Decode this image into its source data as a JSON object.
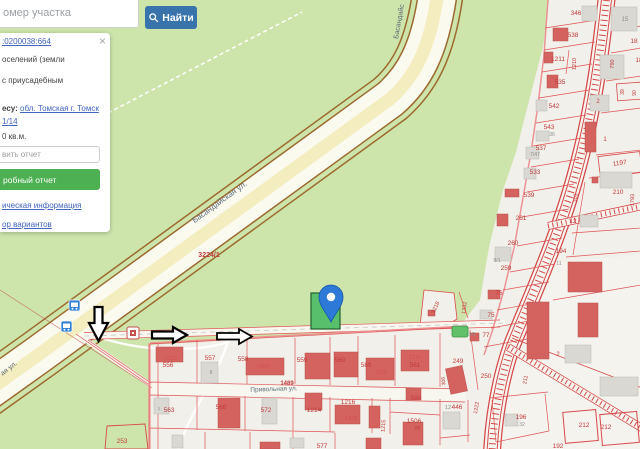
{
  "search": {
    "placeholder": "омер участка",
    "button_label": "Найти"
  },
  "panel": {
    "close": "×",
    "cadastral_link": ":0200038:664",
    "line1": "оселений (земли",
    "line2": "с приусадебным",
    "address_label": "есу:",
    "address_link": "обл. Томская г. Томск",
    "address_link2": "1/14",
    "area": "0 кв.м.",
    "report_placeholder": "вить отчет",
    "report_button": "робный отчет",
    "link_info": "ическая информация",
    "link_variants": "ор вариантов"
  },
  "map": {
    "selected_marker_parcel": "66",
    "labels": [
      {
        "t": "Басандайская ул.",
        "x": 221,
        "y": 204,
        "r": -36,
        "c": "st",
        "s": 8
      },
      {
        "t": "Басандайс",
        "x": 401,
        "y": 22,
        "r": -80,
        "c": "st",
        "s": 7
      },
      {
        "t": "ая ул.",
        "x": 10,
        "y": 370,
        "r": -38,
        "c": "st",
        "s": 7
      },
      {
        "t": "Привольная ул.",
        "x": 274,
        "y": 391,
        "r": -2,
        "c": "st",
        "s": 6.5
      },
      {
        "t": "3224/1",
        "x": 209,
        "y": 257,
        "c": "rn",
        "s": 7
      },
      {
        "t": "1489",
        "x": 287,
        "y": 385,
        "c": "rn",
        "s": 6
      },
      {
        "t": "556",
        "x": 168,
        "y": 367,
        "c": "p"
      },
      {
        "t": "1325",
        "x": 171,
        "y": 360,
        "c": "b",
        "s": 5.5
      },
      {
        "t": "557",
        "x": 210,
        "y": 360,
        "c": "p"
      },
      {
        "t": "8",
        "x": 211,
        "y": 374,
        "c": "g",
        "s": 5
      },
      {
        "t": "558",
        "x": 243,
        "y": 361,
        "c": "p"
      },
      {
        "t": "6404",
        "x": 263,
        "y": 368,
        "c": "b",
        "s": 5.5
      },
      {
        "t": "559",
        "x": 302,
        "y": 362,
        "c": "p"
      },
      {
        "t": "560",
        "x": 340,
        "y": 362,
        "c": "p"
      },
      {
        "t": "589",
        "x": 366,
        "y": 367,
        "c": "p"
      },
      {
        "t": "1220",
        "x": 381,
        "y": 374,
        "c": "b",
        "s": 5.5
      },
      {
        "t": "1719",
        "x": 415,
        "y": 359,
        "c": "b",
        "s": 5.5
      },
      {
        "t": "561",
        "x": 415,
        "y": 367,
        "c": "p"
      },
      {
        "t": "249",
        "x": 458,
        "y": 363,
        "c": "p"
      },
      {
        "t": "306",
        "x": 445,
        "y": 381,
        "r": -95,
        "c": "p",
        "s": 5
      },
      {
        "t": "250",
        "x": 486,
        "y": 378,
        "c": "p"
      },
      {
        "t": "563",
        "x": 169,
        "y": 412,
        "c": "p"
      },
      {
        "t": "1",
        "x": 159,
        "y": 410,
        "c": "g",
        "s": 4.5
      },
      {
        "t": "568",
        "x": 221,
        "y": 409,
        "c": "p"
      },
      {
        "t": "572",
        "x": 266,
        "y": 412,
        "c": "p"
      },
      {
        "t": "1214",
        "x": 314,
        "y": 412,
        "c": "p"
      },
      {
        "t": "1216",
        "x": 348,
        "y": 404,
        "c": "p"
      },
      {
        "t": "1428",
        "x": 351,
        "y": 420,
        "c": "b",
        "s": 5.5
      },
      {
        "t": "1215",
        "x": 385,
        "y": 426,
        "r": -85,
        "c": "p",
        "s": 5.5
      },
      {
        "t": "584",
        "x": 416,
        "y": 400,
        "c": "p"
      },
      {
        "t": "1506",
        "x": 414,
        "y": 423,
        "c": "p"
      },
      {
        "t": "78",
        "x": 417,
        "y": 430,
        "c": "p",
        "s": 5
      },
      {
        "t": "12",
        "x": 448,
        "y": 409,
        "c": "g",
        "s": 5.5
      },
      {
        "t": "446",
        "x": 457,
        "y": 409,
        "c": "p"
      },
      {
        "t": "1222",
        "x": 478,
        "y": 408,
        "r": -80,
        "c": "p",
        "s": 5.5
      },
      {
        "t": "211",
        "x": 527,
        "y": 380,
        "r": -80,
        "c": "p",
        "s": 5.5
      },
      {
        "t": "196",
        "x": 521,
        "y": 419,
        "c": "p"
      },
      {
        "t": "32",
        "x": 522,
        "y": 426,
        "c": "g",
        "s": 5
      },
      {
        "t": "212",
        "x": 584,
        "y": 427,
        "c": "p"
      },
      {
        "t": "212",
        "x": 606,
        "y": 429,
        "c": "p"
      },
      {
        "t": "192",
        "x": 558,
        "y": 448,
        "c": "p"
      },
      {
        "t": "2",
        "x": 558,
        "y": 356,
        "c": "p",
        "s": 6
      },
      {
        "t": "577",
        "x": 322,
        "y": 448,
        "c": "p"
      },
      {
        "t": "253",
        "x": 122,
        "y": 443,
        "c": "p"
      },
      {
        "t": "346",
        "x": 576,
        "y": 15,
        "c": "p"
      },
      {
        "t": "538",
        "x": 573,
        "y": 37,
        "c": "p"
      },
      {
        "t": "1211",
        "x": 558,
        "y": 61,
        "c": "p"
      },
      {
        "t": "1210",
        "x": 576,
        "y": 64,
        "r": -90,
        "c": "p",
        "s": 5.5
      },
      {
        "t": "535",
        "x": 560,
        "y": 84,
        "c": "p"
      },
      {
        "t": "542",
        "x": 554,
        "y": 108,
        "c": "p"
      },
      {
        "t": "543",
        "x": 549,
        "y": 129,
        "c": "p"
      },
      {
        "t": "36",
        "x": 552,
        "y": 136,
        "c": "g",
        "s": 5
      },
      {
        "t": "537",
        "x": 541,
        "y": 150,
        "c": "p"
      },
      {
        "t": "7/47",
        "x": 535,
        "y": 156,
        "c": "g",
        "s": 5
      },
      {
        "t": "533",
        "x": 535,
        "y": 174,
        "c": "p"
      },
      {
        "t": "539",
        "x": 529,
        "y": 197,
        "c": "p"
      },
      {
        "t": "261",
        "x": 521,
        "y": 220,
        "c": "p"
      },
      {
        "t": "260",
        "x": 513,
        "y": 245,
        "c": "p"
      },
      {
        "t": "259",
        "x": 506,
        "y": 270,
        "c": "p"
      },
      {
        "t": "9/1",
        "x": 497,
        "y": 262,
        "c": "g",
        "s": 5
      },
      {
        "t": "76",
        "x": 499,
        "y": 295,
        "c": "p"
      },
      {
        "t": "75",
        "x": 491,
        "y": 317,
        "c": "p"
      },
      {
        "t": "1/3",
        "x": 472,
        "y": 336,
        "c": "g",
        "s": 5
      },
      {
        "t": "77",
        "x": 486,
        "y": 337,
        "c": "p"
      },
      {
        "t": "1218",
        "x": 437,
        "y": 308,
        "r": -65,
        "c": "p",
        "s": 5.5
      },
      {
        "t": "1352",
        "x": 466,
        "y": 308,
        "r": -82,
        "c": "p",
        "s": 5.5
      },
      {
        "t": "15",
        "x": 625,
        "y": 21,
        "c": "g",
        "s": 6
      },
      {
        "t": "18",
        "x": 634,
        "y": 43,
        "c": "p"
      },
      {
        "t": "18",
        "x": 639,
        "y": 62,
        "c": "p"
      },
      {
        "t": "790",
        "x": 614,
        "y": 64,
        "r": -90,
        "c": "p",
        "s": 5.5
      },
      {
        "t": "2",
        "x": 598,
        "y": 103,
        "c": "p",
        "s": 6
      },
      {
        "t": "39",
        "x": 624,
        "y": 92,
        "r": -90,
        "c": "p",
        "s": 5
      },
      {
        "t": "90",
        "x": 636,
        "y": 93,
        "r": -90,
        "c": "p",
        "s": 5
      },
      {
        "t": "1",
        "x": 605,
        "y": 141,
        "c": "p"
      },
      {
        "t": "1197",
        "x": 620,
        "y": 165,
        "r": -8,
        "c": "p"
      },
      {
        "t": "210",
        "x": 618,
        "y": 194,
        "c": "p"
      },
      {
        "t": "301",
        "x": 577,
        "y": 198,
        "r": -85,
        "c": "p",
        "s": 5.5
      },
      {
        "t": "12",
        "x": 573,
        "y": 223,
        "c": "p"
      },
      {
        "t": "194",
        "x": 561,
        "y": 253,
        "c": "p"
      },
      {
        "t": "11",
        "x": 559,
        "y": 265,
        "c": "g",
        "s": 5
      },
      {
        "t": "1793",
        "x": 634,
        "y": 200,
        "r": -88,
        "c": "p",
        "s": 5.5
      },
      {
        "t": "66",
        "x": 327,
        "y": 313,
        "c": "mk",
        "s": 4.5
      }
    ]
  }
}
